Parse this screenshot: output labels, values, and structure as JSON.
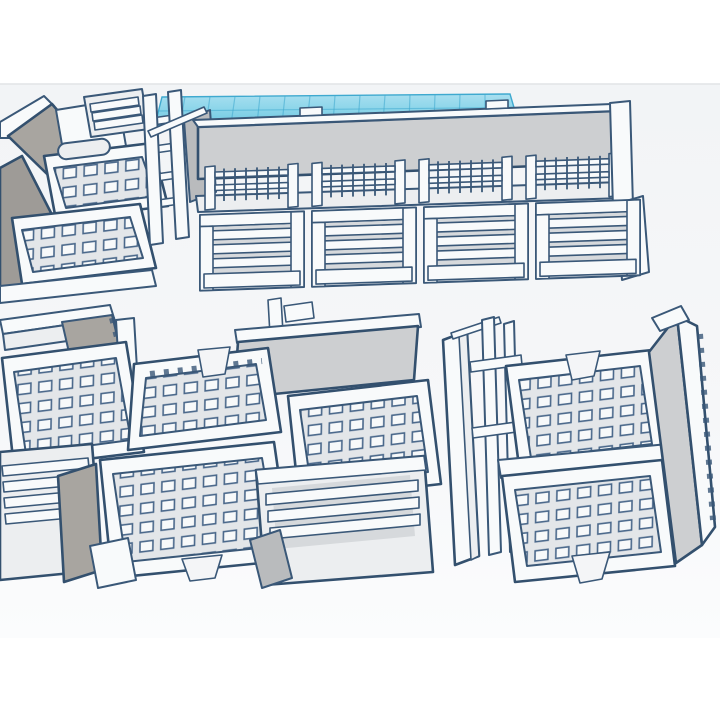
{
  "scene": {
    "type": "3d-model-render",
    "viewport_style": "cad-viewport",
    "background": "#ffffff",
    "render_band": {
      "top": 84,
      "bottom": 638,
      "fill": "#f4f5f7",
      "edge": "#e1e3e5"
    },
    "colors": {
      "outline": "#3a5878",
      "outline_dark": "#33506e",
      "plastic_white": "#f8fafb",
      "plastic_light": "#eceef0",
      "plastic_mid": "#cdcfd1",
      "plastic_gray": "#b9bbbd",
      "shadow_gray": "#a8a5a0",
      "recess": "#d6d9dc",
      "grate_bar": "#e3e6e9",
      "grate_hole": "#f7f9fa",
      "workplane_blue": "#79cde5",
      "workplane_blue_light": "#a9dff0",
      "workplane_line": "#3fa9cf"
    },
    "objects": [
      {
        "id": "workplane-grid",
        "label": "blue workplane grid"
      },
      {
        "id": "room-tiles-topleft",
        "label": "cropped room tiles with gray corner walls and pipe"
      },
      {
        "id": "stair-piece",
        "label": "small stair piece"
      },
      {
        "id": "ladder-endcap",
        "label": "ladder end-cap with rails"
      },
      {
        "id": "corridor-assembly",
        "label": "long wall with grated walkway bays and louvered panel modules"
      },
      {
        "id": "room-cluster-left",
        "label": "large assembly of grated floor tiles, walls and stair modules"
      },
      {
        "id": "room-cluster-right",
        "label": "assembly of grated floor tiles between side walls"
      }
    ]
  }
}
